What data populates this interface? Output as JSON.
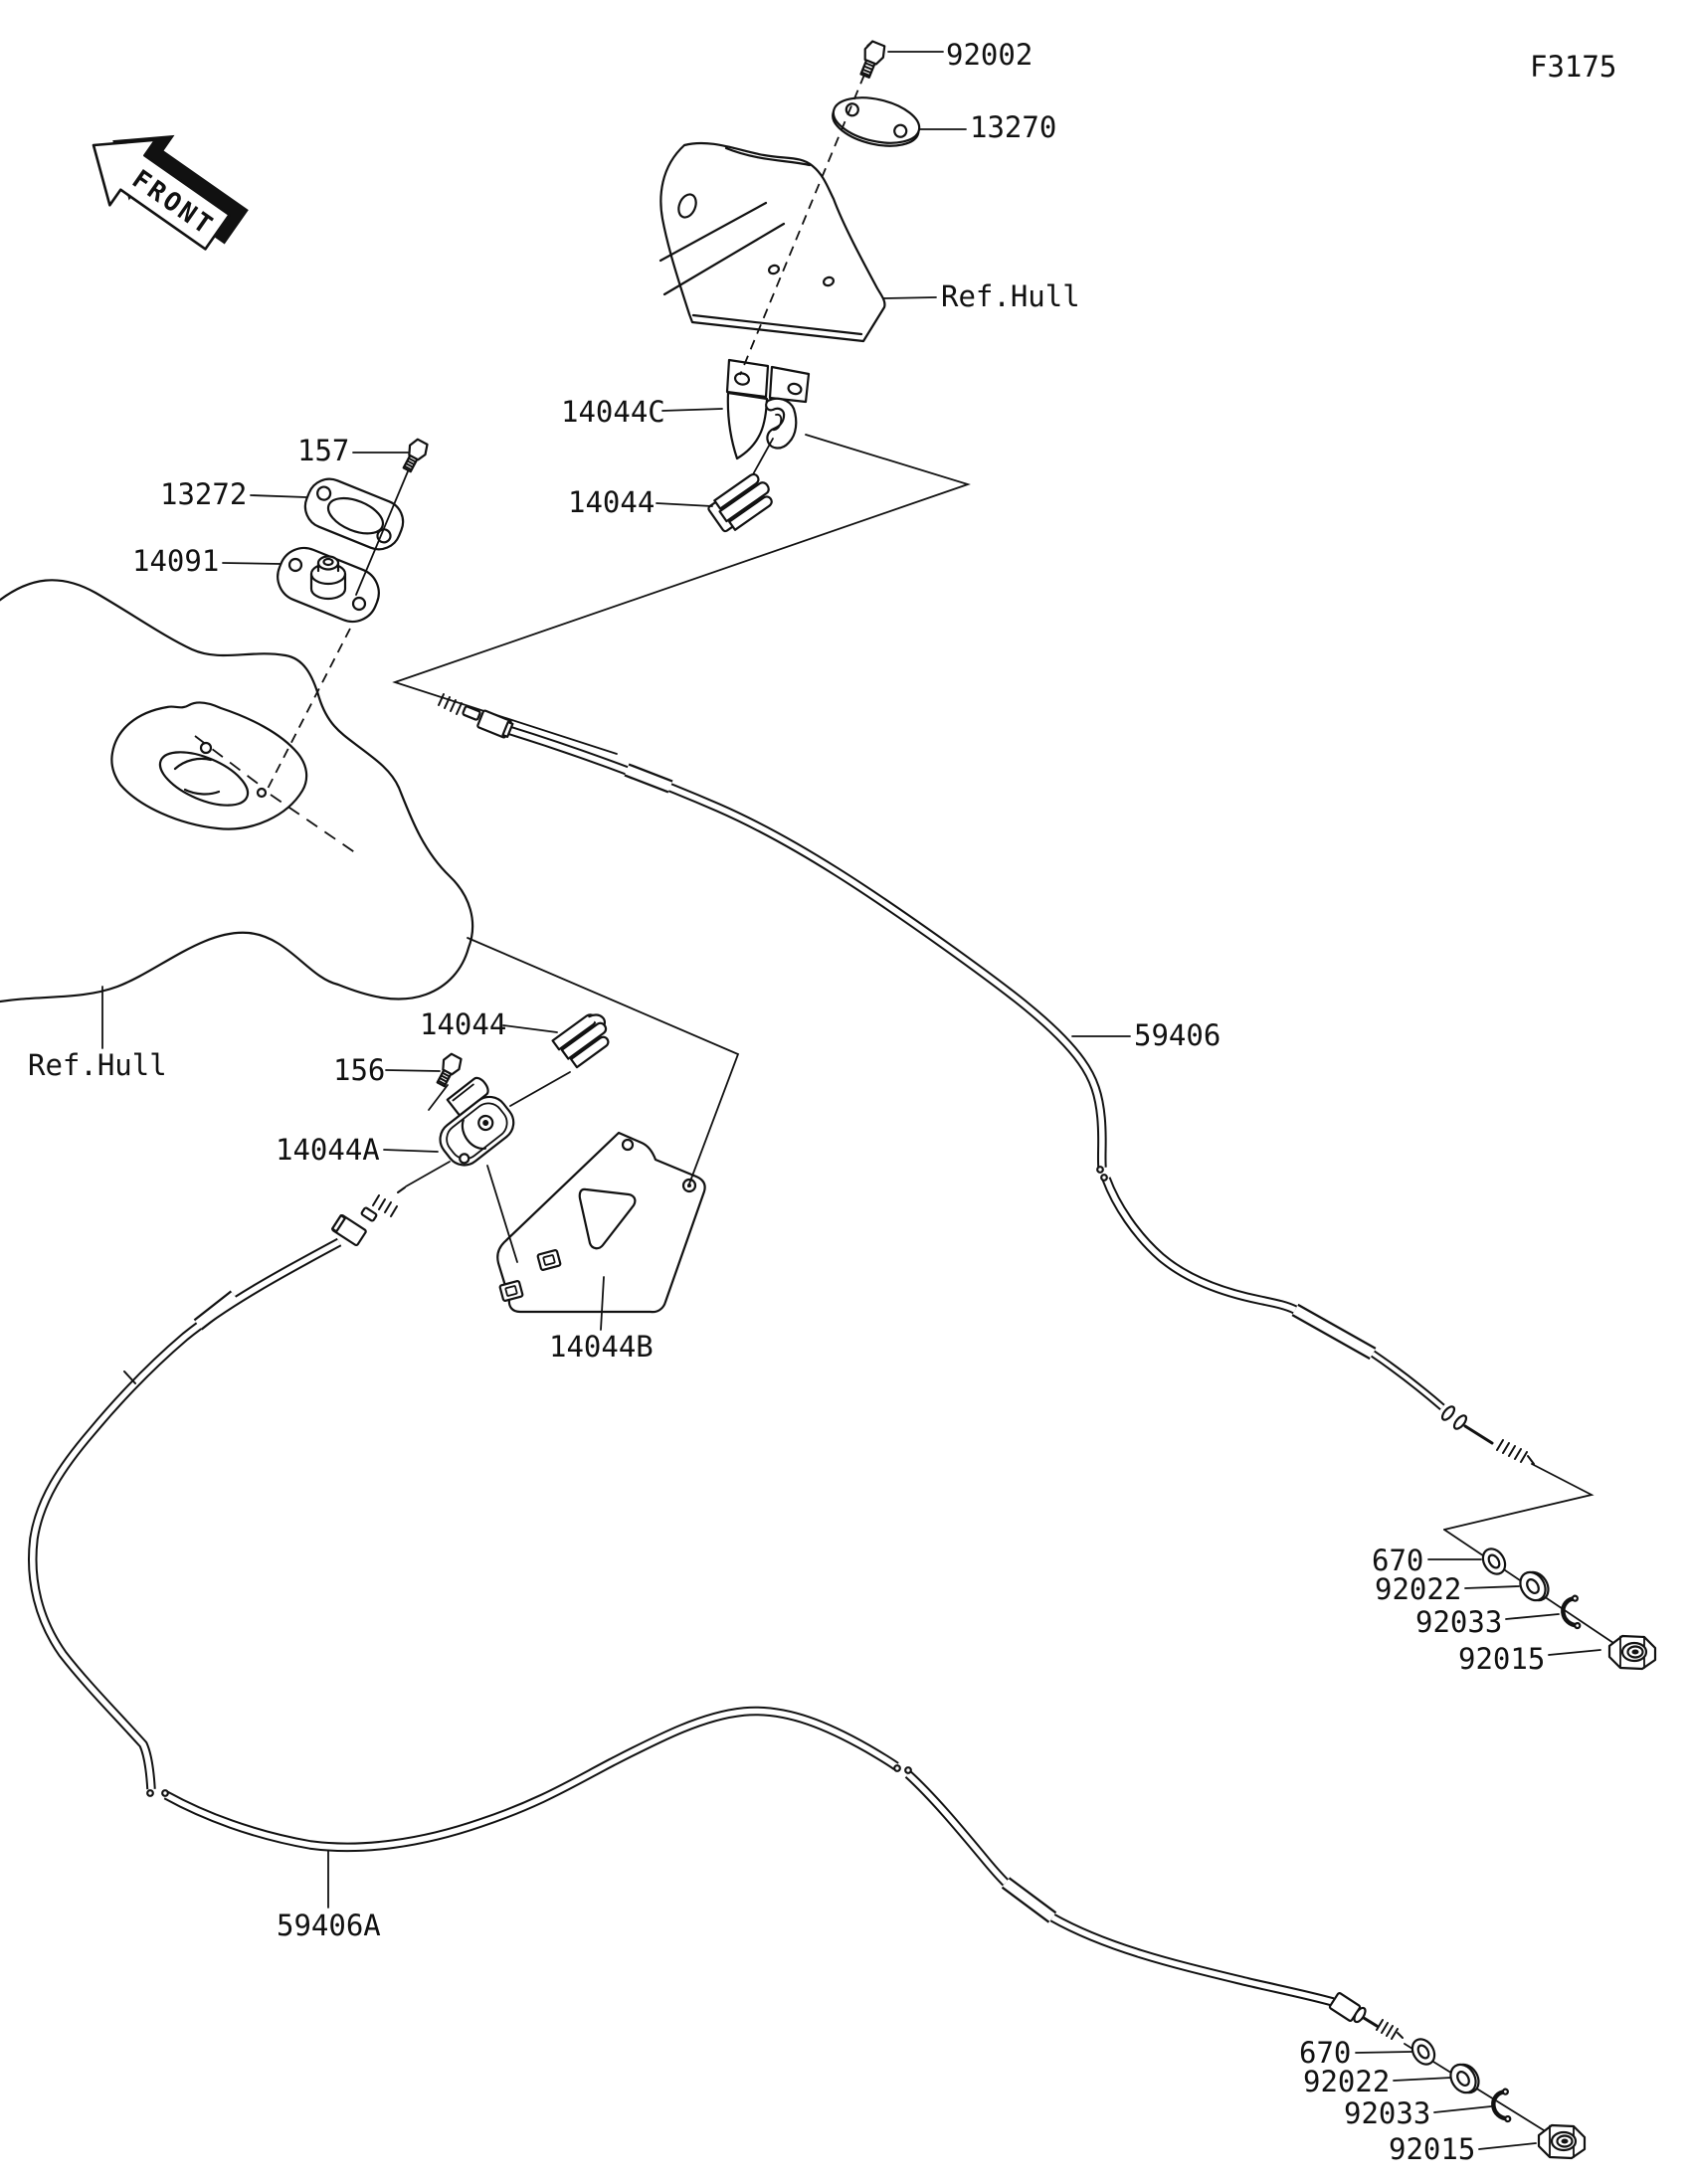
{
  "figure": {
    "code": "F3175",
    "orientation_label": "FRONT"
  },
  "colors": {
    "line": "#111111",
    "background": "#ffffff"
  },
  "callouts": {
    "upper_assembly": {
      "bolt": "92002",
      "cover_plate": "13270",
      "hull_reference": "Ref.Hull",
      "cable_bracket": "14044C",
      "cable_clamp": "14044"
    },
    "steering_mount": {
      "screw": "157",
      "gasket": "13272",
      "cable_mount": "14091"
    },
    "hull_left": {
      "hull_reference": "Ref.Hull"
    },
    "mid_assembly": {
      "cable_clip": "14044",
      "screw": "156",
      "cable_holder": "14044A",
      "cable_bracket": "14044B"
    },
    "cables": {
      "steering_cable": "59406",
      "secondary_cable": "59406A"
    },
    "upper_cable_end_hardware": {
      "o_ring": "670",
      "washer": "92022",
      "circlip": "92033",
      "nut": "92015"
    },
    "lower_cable_end_hardware": {
      "o_ring": "670",
      "washer": "92022",
      "circlip": "92033",
      "nut": "92015"
    }
  }
}
